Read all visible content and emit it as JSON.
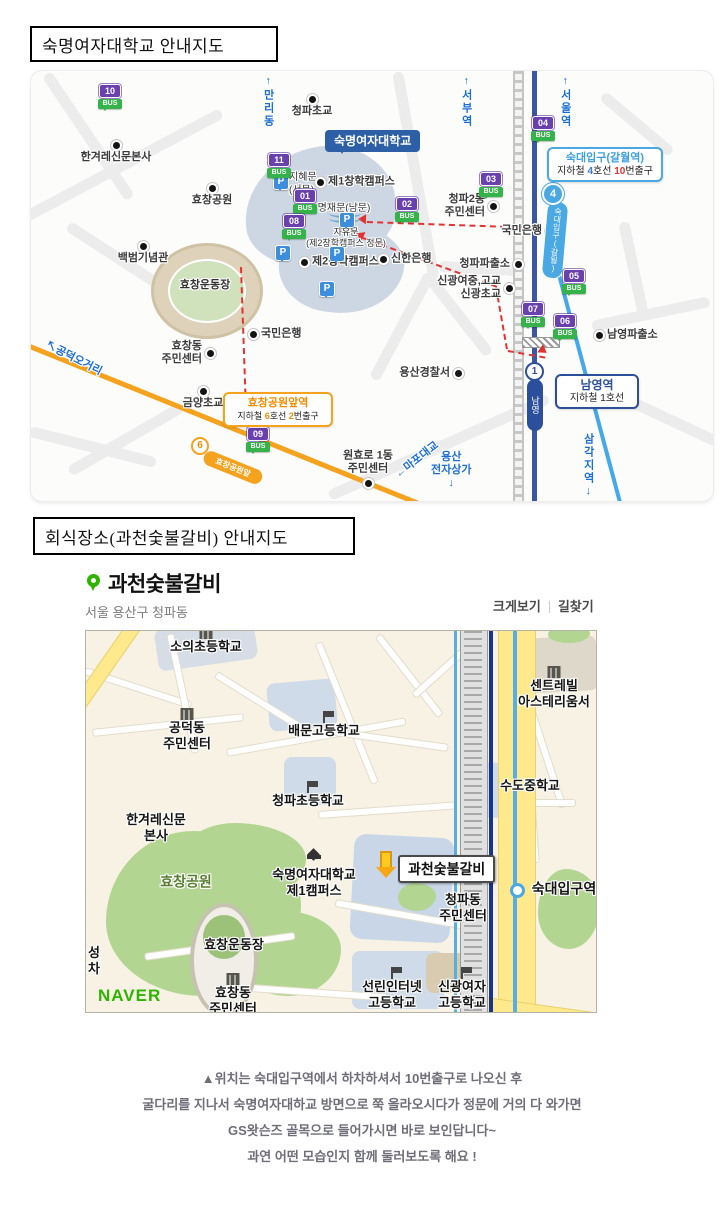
{
  "ui": {
    "bus_word": "BUS",
    "parking_letter": "P",
    "naver_logo": "NAVER"
  },
  "colors": {
    "line4_navy": "#3a57a7",
    "line1_blue": "#45a8e8",
    "line6_orange": "#f5a21f",
    "route_red": "#e23333",
    "bus_purple": "#6a3fae",
    "bus_green": "#35b24a",
    "univ_blue": "#2d5fa7",
    "station_lightblue": "#4aa8e2",
    "naver_green": "#2db400",
    "marker_green": "#2db400",
    "map2_yellow": "#ffe98c"
  },
  "titles": {
    "map1": "숙명여자대학교 안내지도",
    "map2": "회식장소(과천숯불갈비)  안내지도"
  },
  "map1": {
    "univ_callout": "숙명여자대학교",
    "stations": {
      "line4": {
        "num": "4",
        "name": "숙대입구(갈월)"
      },
      "line1": {
        "num": "1",
        "name": "남영"
      },
      "line6": {
        "num": "6",
        "name": "효창공원앞"
      }
    },
    "sukdae_callout": {
      "title": "숙대입구(갈월역)",
      "pre": "지하철 ",
      "line_num": "4",
      "mid": "호선 ",
      "exit_num": "10",
      "post": "번출구"
    },
    "namyeong_callout": {
      "title": "남영역",
      "line": "지하철 1호선"
    },
    "hyochang_callout": {
      "title": "효창공원앞역",
      "pre": "지하철 ",
      "line_num": "6",
      "mid": "호선 ",
      "exit_num": "2",
      "post": "번출구"
    },
    "bus_stops": [
      {
        "num": "10",
        "x": 67,
        "y": 13
      },
      {
        "num": "11",
        "x": 236,
        "y": 82
      },
      {
        "num": "01",
        "x": 262,
        "y": 118
      },
      {
        "num": "08",
        "x": 251,
        "y": 143
      },
      {
        "num": "02",
        "x": 364,
        "y": 126
      },
      {
        "num": "03",
        "x": 448,
        "y": 101
      },
      {
        "num": "04",
        "x": 500,
        "y": 45
      },
      {
        "num": "05",
        "x": 531,
        "y": 198
      },
      {
        "num": "07",
        "x": 490,
        "y": 231
      },
      {
        "num": "06",
        "x": 522,
        "y": 243
      },
      {
        "num": "09",
        "x": 215,
        "y": 356
      }
    ],
    "pois": [
      {
        "t": "청파초교",
        "x": 281,
        "y": 28,
        "p": "n"
      },
      {
        "t": "한겨레신문본사",
        "x": 85,
        "y": 74,
        "p": "n"
      },
      {
        "t": "효창공원",
        "x": 181,
        "y": 117,
        "p": "n"
      },
      {
        "t": "백범기념관",
        "x": 112,
        "y": 175,
        "p": "n"
      },
      {
        "t": "제1창학캠퍼스",
        "x": 289,
        "y": 111,
        "p": "w"
      },
      {
        "t": "제2창학캠퍼스",
        "x": 273,
        "y": 191,
        "p": "w"
      },
      {
        "t": "신한은행",
        "x": 352,
        "y": 188,
        "p": "w"
      },
      {
        "t": "신광여중,고교\n신광초교",
        "x": 478,
        "y": 217,
        "p": "e"
      },
      {
        "t": "청파2동\n주민센터",
        "x": 462,
        "y": 135,
        "p": "e"
      },
      {
        "t": "국민은행",
        "x": 519,
        "y": 160,
        "p": "e"
      },
      {
        "t": "청파파출소",
        "x": 487,
        "y": 193,
        "p": "e"
      },
      {
        "t": "국민은행",
        "x": 222,
        "y": 263,
        "p": "w"
      },
      {
        "t": "효창동\n주민센터",
        "x": 179,
        "y": 282,
        "p": "e"
      },
      {
        "t": "금양초교",
        "x": 172,
        "y": 320,
        "p": "n"
      },
      {
        "t": "원효로 1동\n주민센터",
        "x": 337,
        "y": 412,
        "p": "s"
      },
      {
        "t": "용산경찰서",
        "x": 427,
        "y": 302,
        "p": "e"
      },
      {
        "t": "남영파출소",
        "x": 568,
        "y": 264,
        "p": "w"
      }
    ],
    "plain_labels": [
      {
        "t": "지혜문\n(서문)",
        "x": 258,
        "y": 101,
        "a": "l",
        "s": 10
      },
      {
        "t": "명재문(남문)",
        "x": 313,
        "y": 132,
        "a": "c",
        "s": 10
      },
      {
        "t": "자유문\n(제2창학캠퍼스 정문)",
        "x": 315,
        "y": 156,
        "a": "c",
        "s": 9
      },
      {
        "t": "효창운동장",
        "x": 174,
        "y": 208,
        "a": "c",
        "s": 11,
        "b": true
      }
    ],
    "blue_labels": [
      {
        "t": "↑만리동",
        "x": 230,
        "y": 4,
        "v": true
      },
      {
        "t": "↑서부역",
        "x": 428,
        "y": 4,
        "v": true
      },
      {
        "t": "↑서울역",
        "x": 527,
        "y": 4,
        "v": true
      },
      {
        "t": "삼각지역↓",
        "x": 550,
        "y": 362,
        "v": true
      },
      {
        "t": "↖공덕오거리",
        "x": 18,
        "y": 268,
        "r": 27
      },
      {
        "t": "←마포대교",
        "x": 362,
        "y": 400,
        "r": -38
      },
      {
        "t": "용산\n전자상가\n↓",
        "x": 400,
        "y": 380,
        "c": true
      }
    ],
    "parkings": [
      {
        "x": 242,
        "y": 103
      },
      {
        "x": 308,
        "y": 141
      },
      {
        "x": 244,
        "y": 174
      },
      {
        "x": 298,
        "y": 175
      },
      {
        "x": 288,
        "y": 210
      }
    ]
  },
  "restaurant": {
    "name": "과천숯불갈비",
    "address": "서울 용산구 청파동",
    "link_zoom": "크게보기",
    "link_route": "길찾기"
  },
  "map2": {
    "restaurant_label": "과천숯불갈비",
    "pois": [
      {
        "t": "소의초등학교",
        "x": 120,
        "y": 16,
        "icon": "building"
      },
      {
        "t": "공덕동\n주민센터",
        "x": 101,
        "y": 105,
        "icon": "building"
      },
      {
        "t": "배문고등학교",
        "x": 238,
        "y": 100,
        "icon": "flag"
      },
      {
        "t": "청파초등학교",
        "x": 222,
        "y": 170,
        "icon": "flag"
      },
      {
        "t": "한겨레신문\n본사",
        "x": 70,
        "y": 197,
        "icon": "none"
      },
      {
        "t": "효창공원",
        "x": 100,
        "y": 251,
        "icon": "none",
        "k": "park"
      },
      {
        "t": "숙명여자대학교\n제1캠퍼스",
        "x": 228,
        "y": 252,
        "icon": "cap"
      },
      {
        "t": "효창운동장",
        "x": 148,
        "y": 314,
        "icon": "none"
      },
      {
        "t": "효창동\n주민센터",
        "x": 147,
        "y": 370,
        "icon": "building"
      },
      {
        "t": "선린인터넷\n고등학교",
        "x": 306,
        "y": 364,
        "icon": "flag"
      },
      {
        "t": "신광여자\n고등학교",
        "x": 376,
        "y": 364,
        "icon": "flag"
      },
      {
        "t": "수도중학교",
        "x": 444,
        "y": 155,
        "icon": "none"
      },
      {
        "t": "센트레빌\n아스테리움서",
        "x": 468,
        "y": 63,
        "icon": "building"
      },
      {
        "t": "숙대입구역",
        "x": 478,
        "y": 258,
        "icon": "none",
        "k": "station"
      },
      {
        "t": "청파동\n주민센터",
        "x": 377,
        "y": 277,
        "icon": "none"
      },
      {
        "t": "성\n차",
        "x": 8,
        "y": 330,
        "icon": "none"
      }
    ]
  },
  "footer": {
    "lines": [
      "▲위치는 숙대입구역에서 하차하셔서 10번출구로 나오신 후",
      "굴다리를 지나서 숙명여자대하교 방면으로 쭉 올라오시다가 정문에 거의 다 와가면",
      "GS왓슨즈 골목으로 들어가시면 바로 보인답니다~",
      "과연 어떤 모습인지 함께 둘러보도록 해요 !"
    ]
  }
}
